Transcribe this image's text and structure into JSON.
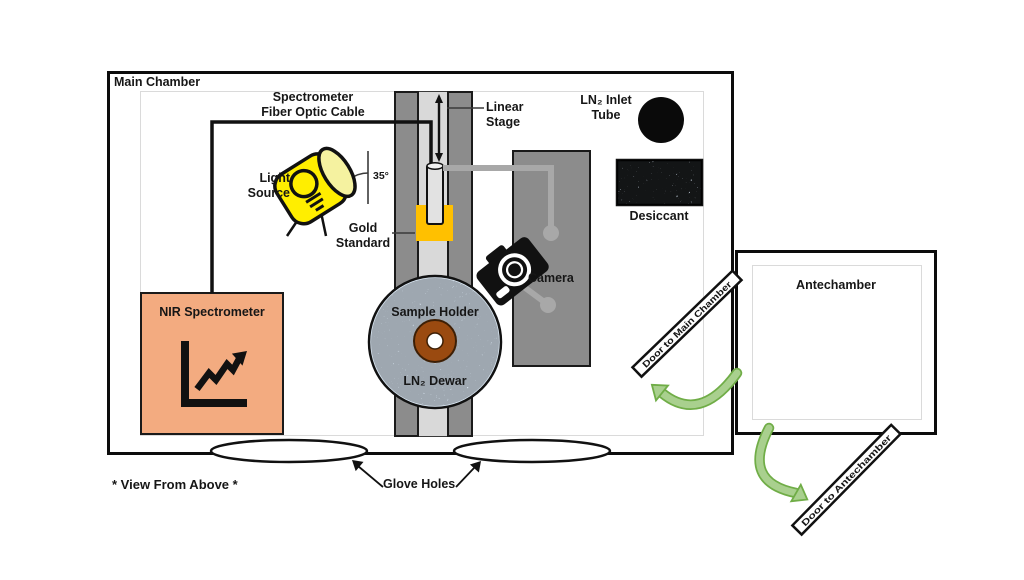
{
  "diagram": {
    "type": "lab-equipment-schematic",
    "view_note": "* View From Above *",
    "main_chamber": {
      "label": "Main Chamber",
      "components": {
        "fiber_optic_cable": "Spectrometer\nFiber Optic Cable",
        "light_source": "Light\nSource",
        "light_angle": "35°",
        "linear_stage": "Linear\nStage",
        "gold_standard": "Gold\nStandard",
        "ln2_inlet_tube": "LN₂ Inlet\nTube",
        "desiccant": "Desiccant",
        "camera": "Camera",
        "nir_spectrometer": "NIR Spectrometer",
        "sample_holder": "Sample Holder",
        "ln2_dewar": "LN₂ Dewar",
        "glove_holes": "Glove Holes"
      }
    },
    "antechamber": {
      "label": "Antechamber",
      "door_to_main_chamber": "Door to Main Chamber",
      "door_to_antechamber": "Door to Antechamber"
    },
    "colors": {
      "nir_spectrometer_fill": "#f3ab80",
      "gold_standard_fill": "#ffc000",
      "light_source_fill": "#ffee00",
      "light_source_face": "#f5f2a0",
      "stage_gray": "#8c8c8c",
      "track_gray": "#d9d9d9",
      "cable_gray": "#a8a8a8",
      "dewar_fill": "#dce9f5",
      "sample_ring_fill": "#9a4a10",
      "desiccant_fill": "#ccd8e6",
      "arrow_green_fill": "#a9d08e",
      "arrow_green_edge": "#70ad47"
    }
  }
}
